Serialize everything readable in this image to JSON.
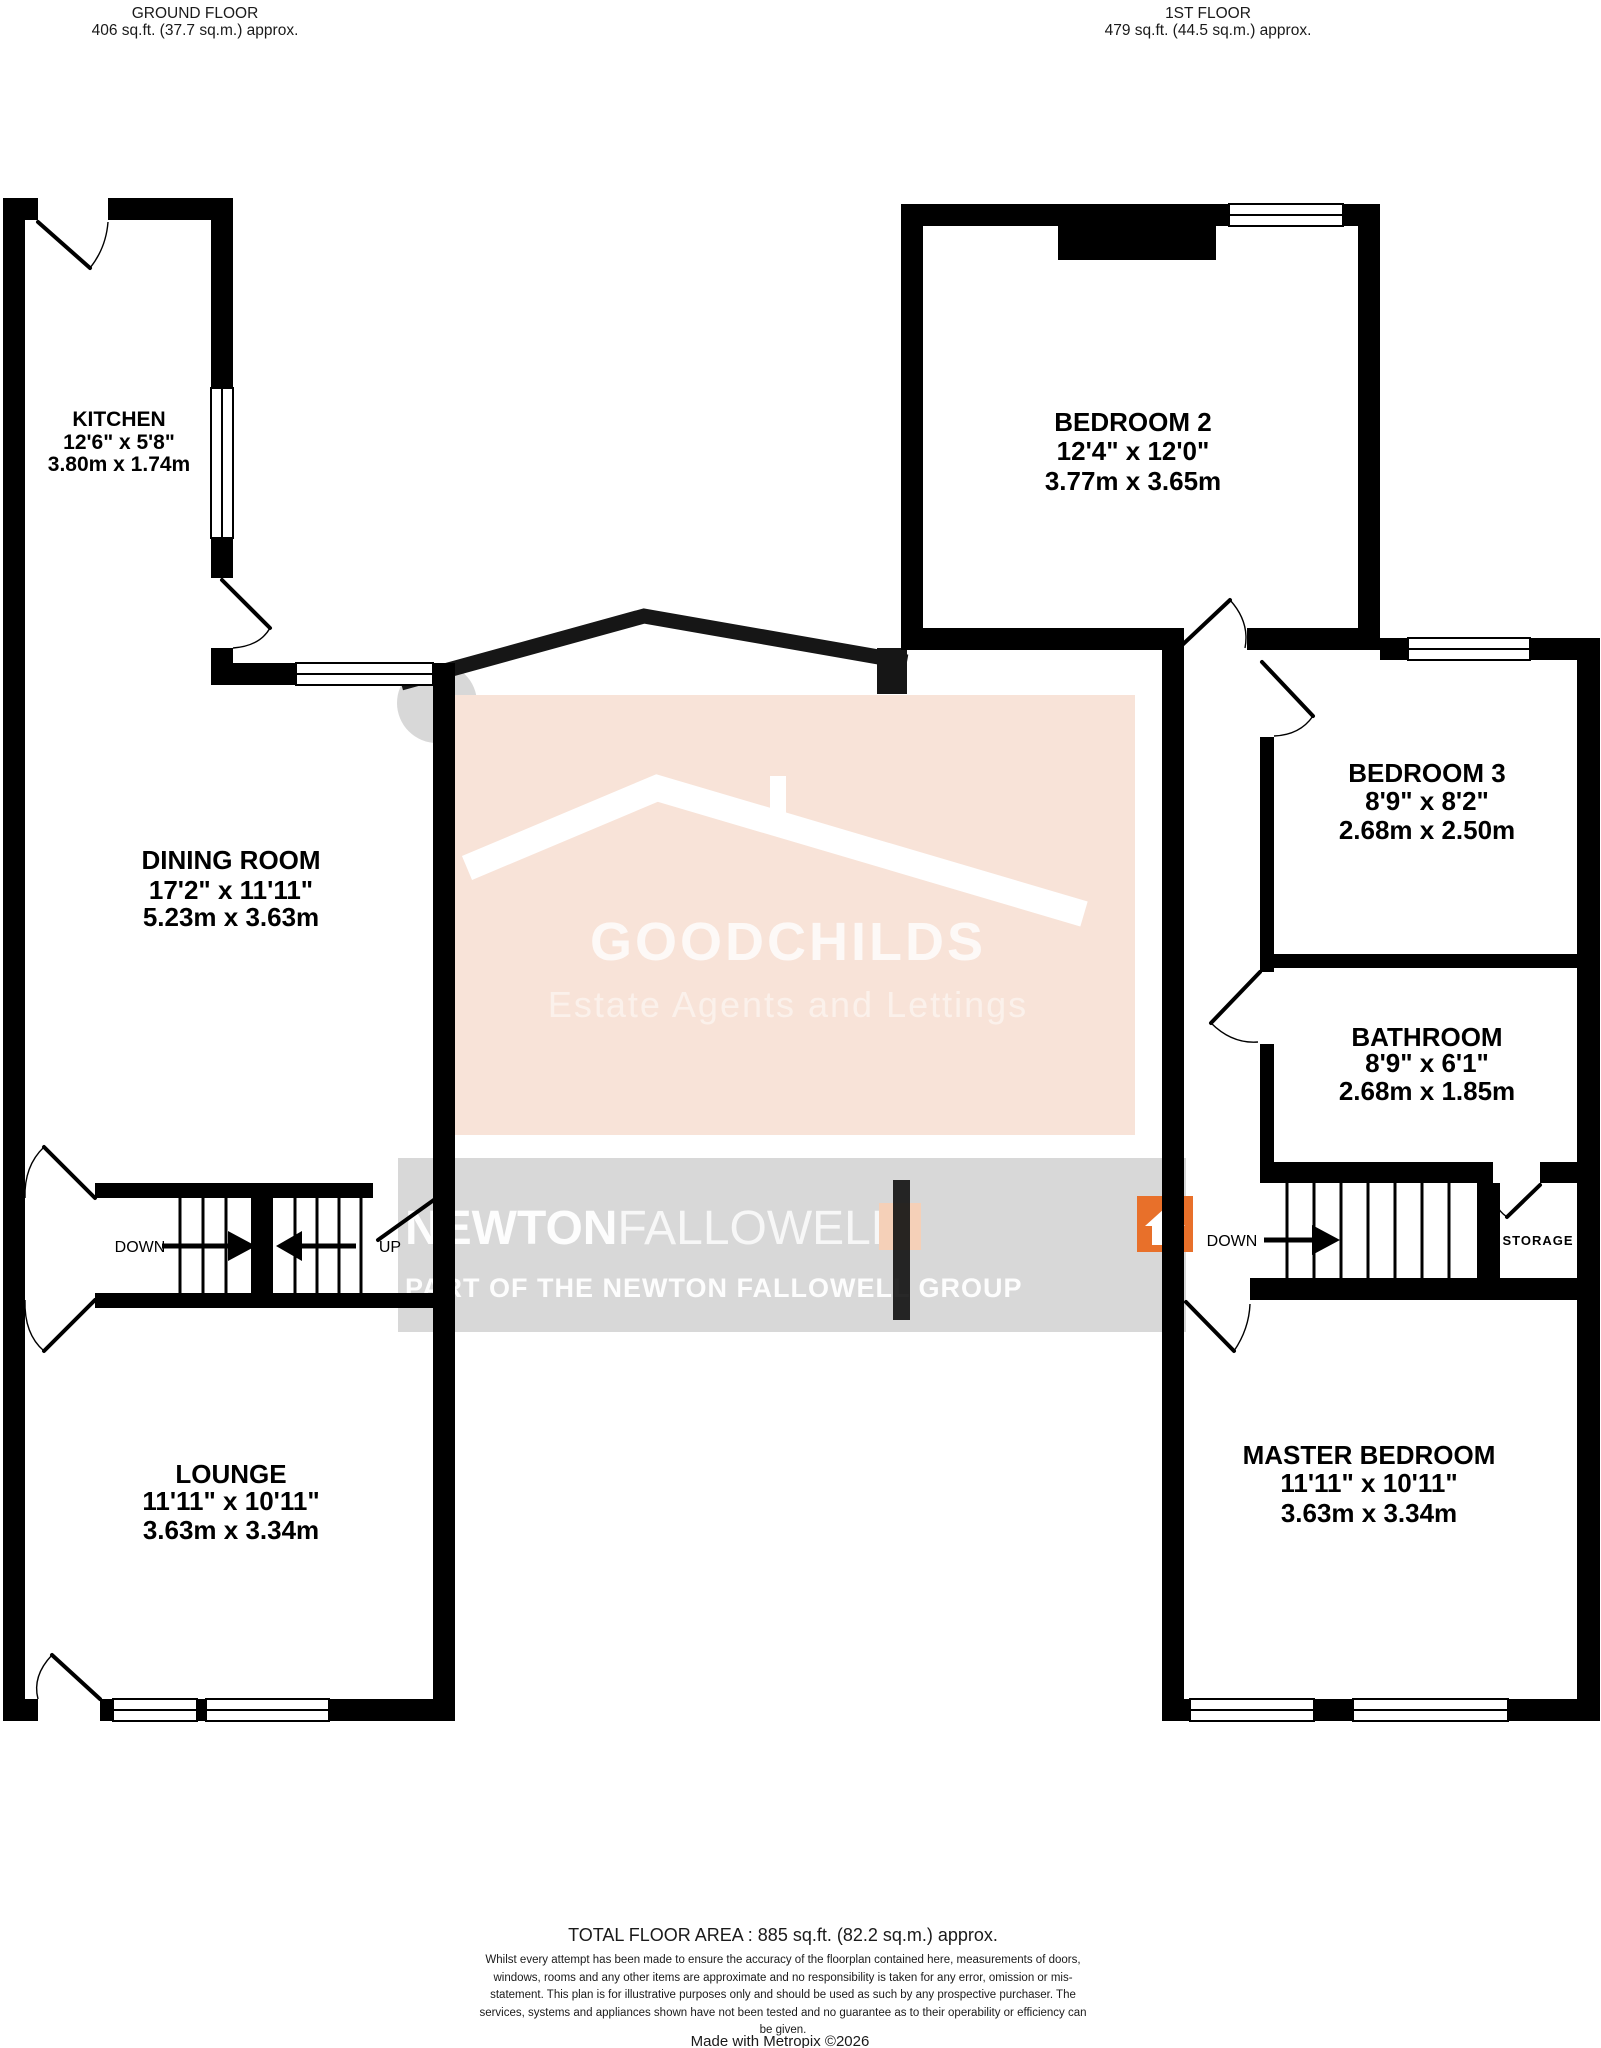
{
  "headers": {
    "ground": {
      "title": "GROUND FLOOR",
      "area": "406 sq.ft. (37.7 sq.m.) approx."
    },
    "first": {
      "title": "1ST FLOOR",
      "area": "479 sq.ft. (44.5 sq.m.) approx."
    }
  },
  "rooms": {
    "kitchen": {
      "name": "KITCHEN",
      "imperial": "12'6\" x 5'8\"",
      "metric": "3.80m x 1.74m"
    },
    "dining": {
      "name": "DINING ROOM",
      "imperial": "17'2\" x 11'11\"",
      "metric": "5.23m x 3.63m"
    },
    "lounge": {
      "name": "LOUNGE",
      "imperial": "11'11\" x 10'11\"",
      "metric": "3.63m x 3.34m"
    },
    "bedroom2": {
      "name": "BEDROOM 2",
      "imperial": "12'4\" x 12'0\"",
      "metric": "3.77m x 3.65m"
    },
    "bedroom3": {
      "name": "BEDROOM 3",
      "imperial": "8'9\" x 8'2\"",
      "metric": "2.68m x 2.50m"
    },
    "bathroom": {
      "name": "BATHROOM",
      "imperial": "8'9\" x 6'1\"",
      "metric": "2.68m x 1.85m"
    },
    "master": {
      "name": "MASTER BEDROOM",
      "imperial": "11'11\" x 10'11\"",
      "metric": "3.63m x 3.34m"
    }
  },
  "stairs": {
    "ground_down": "DOWN",
    "ground_up": "UP",
    "first_down": "DOWN",
    "storage": "STORAGE"
  },
  "watermark": {
    "brand": "GOODCHILDS",
    "tagline": "Estate Agents and Lettings",
    "brand2_bold": "NEWTON",
    "brand2_light": "FALLOWELL",
    "brand2_sub": "PART OF THE NEWTON FALLOWELL GROUP",
    "colors": {
      "peach": "#f8e3d8",
      "gray": "#d8d8d8",
      "orange": "#e8702a",
      "white": "#ffffff"
    }
  },
  "icons": {
    "stairs_arrow_right": "right-arrow",
    "stairs_arrow_left": "left-arrow",
    "house_logo": "house"
  },
  "colors": {
    "walls": "#000000",
    "background": "#ffffff"
  },
  "footer": {
    "total": "TOTAL FLOOR AREA : 885 sq.ft. (82.2 sq.m.) approx.",
    "disclaimer": "Whilst every attempt has been made to ensure the accuracy of the floorplan contained here, measurements of doors, windows, rooms and any other items are approximate and no responsibility is taken for any error, omission or mis-statement. This plan is for illustrative purposes only and should be used as such by any prospective purchaser. The services, systems and appliances shown have not been tested and no guarantee as to their operability or efficiency can be given.",
    "credit": "Made with Metropix ©2026"
  }
}
